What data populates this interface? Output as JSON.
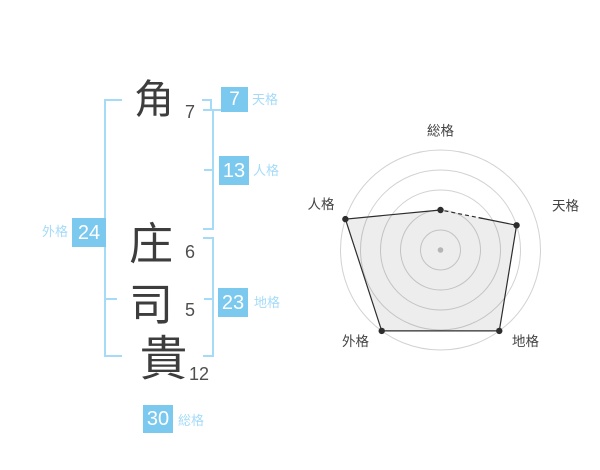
{
  "name_panel": {
    "characters": [
      {
        "char": "角",
        "strokes": "7"
      },
      {
        "char": "庄",
        "strokes": "6"
      },
      {
        "char": "司",
        "strokes": "5"
      },
      {
        "char": "貴",
        "strokes": "12"
      }
    ],
    "gokaku": {
      "tenkaku": {
        "label": "天格",
        "value": "7"
      },
      "jinkaku": {
        "label": "人格",
        "value": "13"
      },
      "gaikaku": {
        "label": "外格",
        "value": "24"
      },
      "chikaku": {
        "label": "地格",
        "value": "23"
      },
      "soukaku": {
        "label": "総格",
        "value": "30"
      }
    }
  },
  "colors": {
    "box_blue": "#7cc9f0",
    "bracket_blue": "#a6dbf7",
    "label_blue": "#a5dbf8",
    "kanji_text": "#3d3d3d",
    "stroke_text": "#4f4f4f",
    "ring": "#d2d2d2",
    "polygon_stroke": "#2d2d2d",
    "polygon_fill": "rgba(0,0,0,0.07)",
    "center_dot": "#b5b5b5",
    "axis_label": "#444444"
  },
  "chart_data": {
    "type": "radar",
    "axes": [
      "総格",
      "天格",
      "地格",
      "外格",
      "人格"
    ],
    "values": [
      2,
      4,
      5,
      5,
      5
    ],
    "scale_max": 5,
    "rings": 5,
    "start_angle_deg": 90,
    "direction": "clockwise",
    "grid": "concentric-circles",
    "legend": "none"
  }
}
